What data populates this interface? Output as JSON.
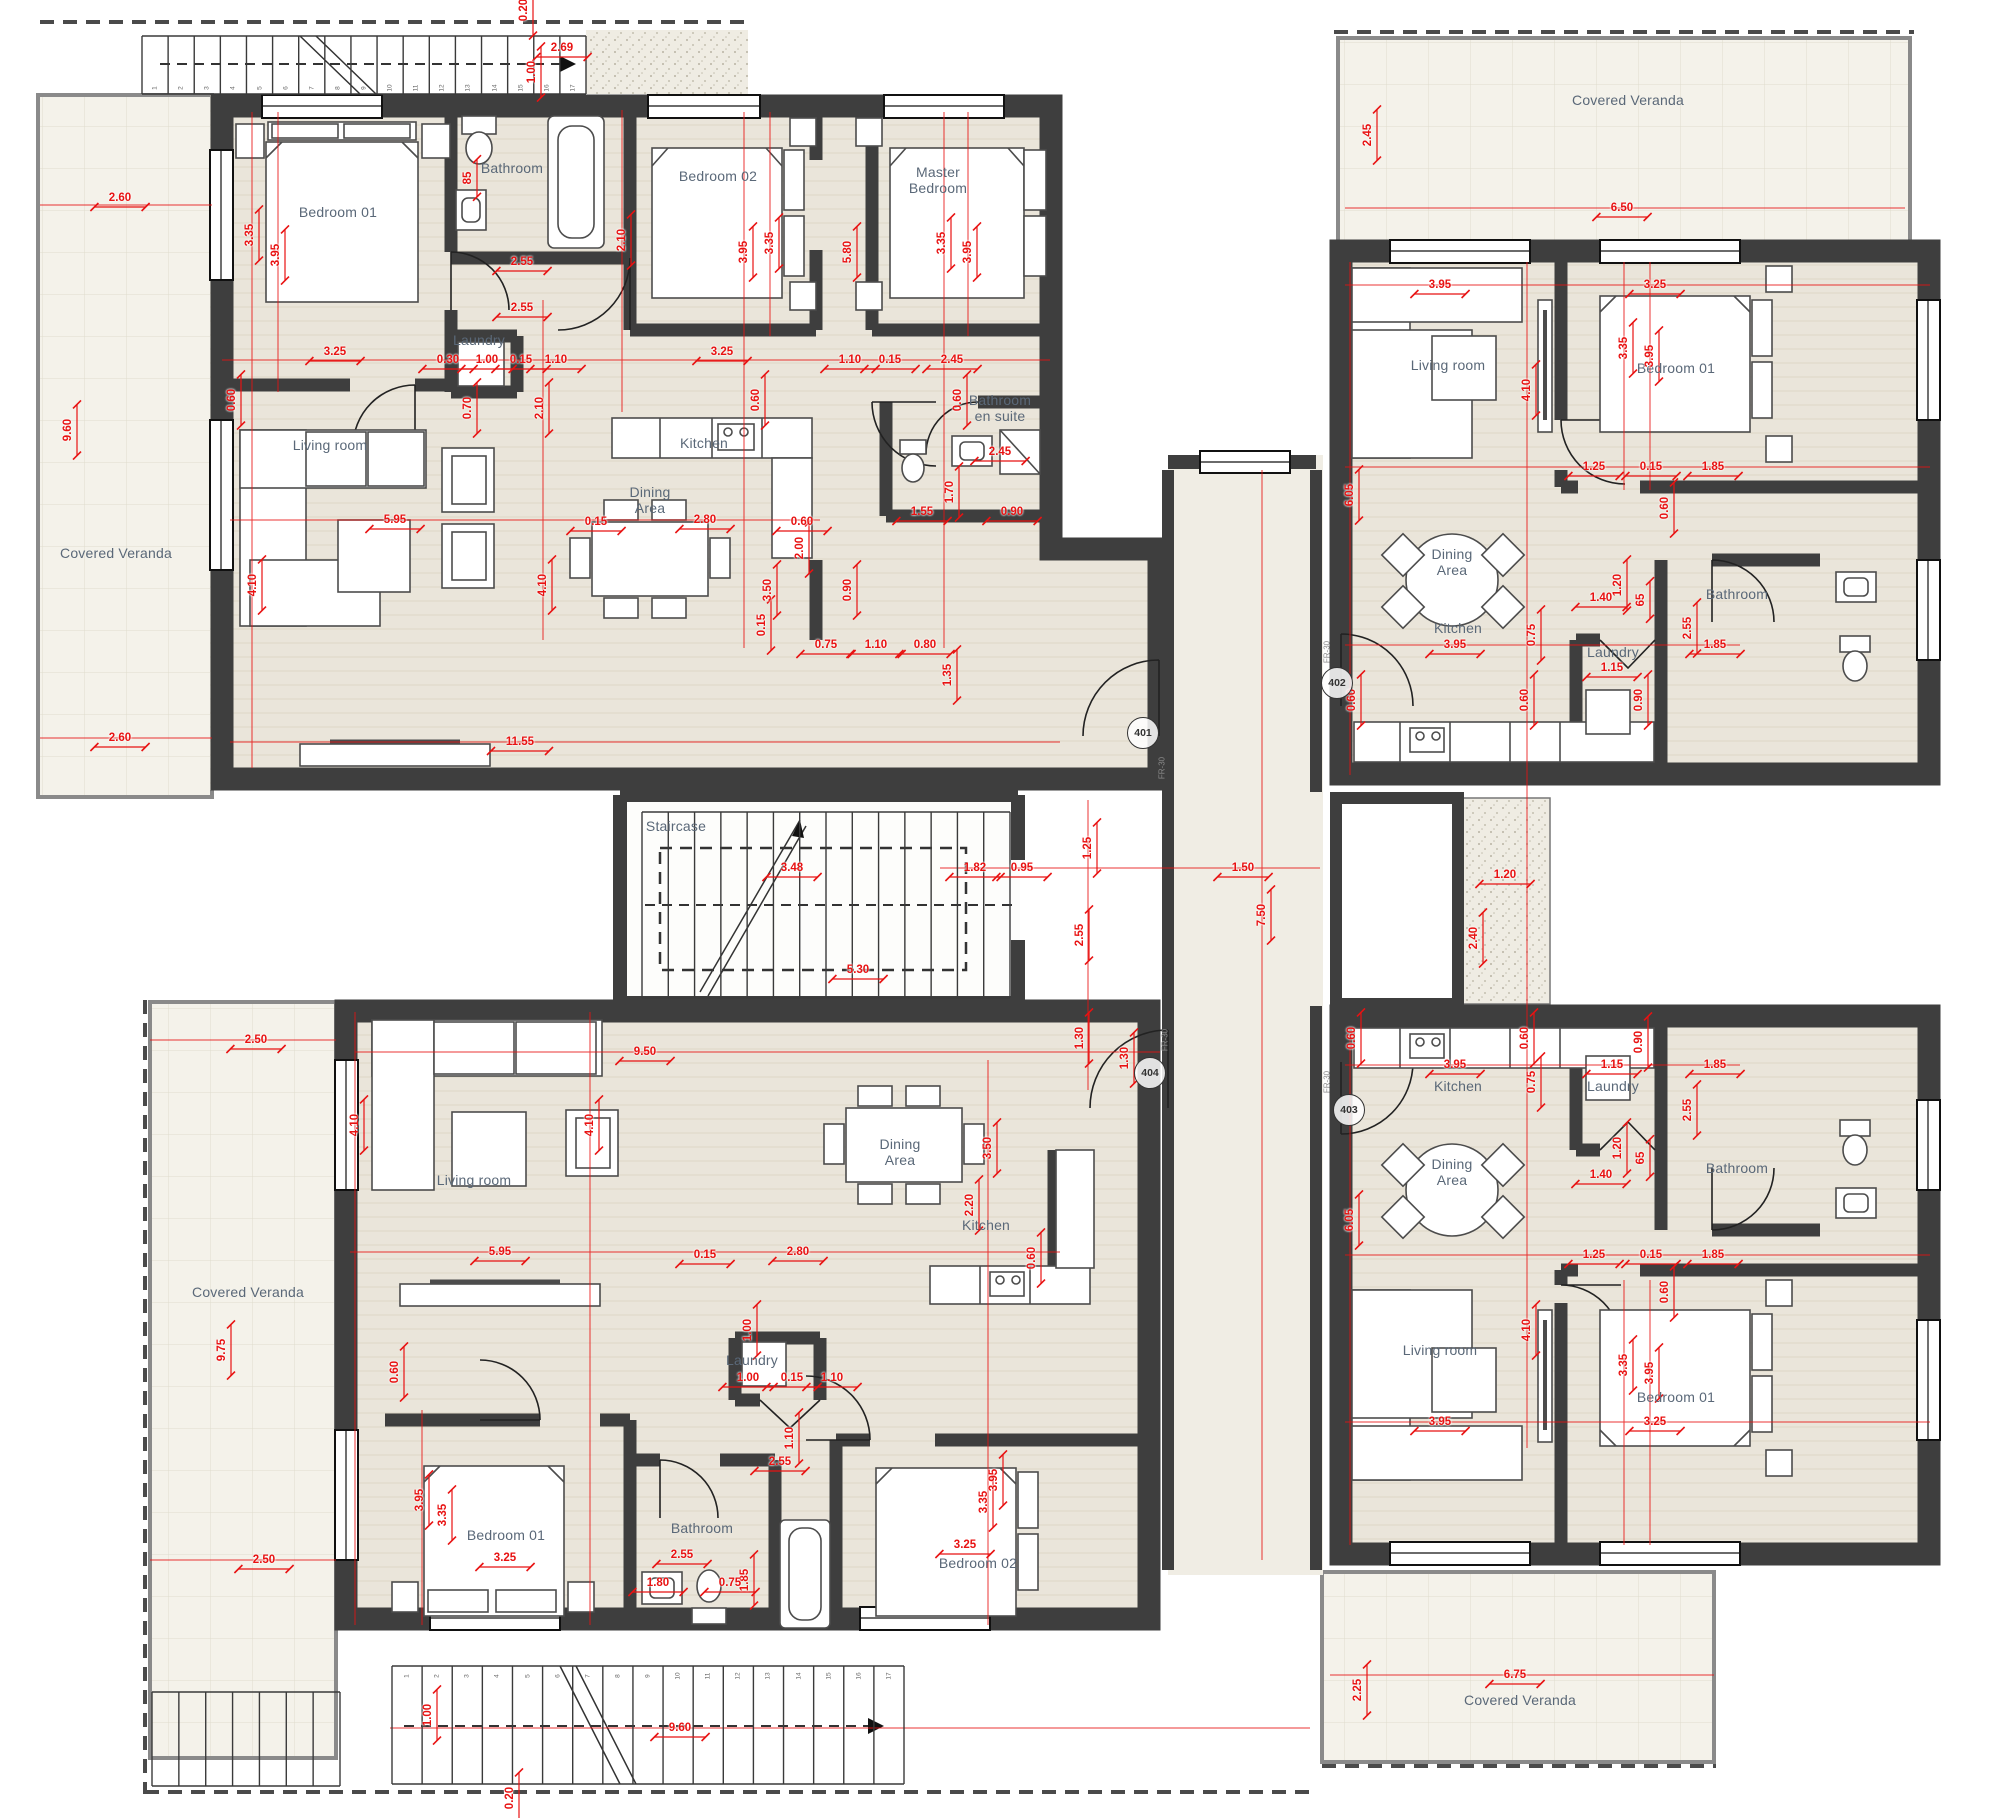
{
  "plan_title": "Typical floor plan – four apartments",
  "colors": {
    "wall": "#3e3e3e",
    "floor": "#eae5da",
    "veranda": "#f4f2ea",
    "corridor": "#f0ede4",
    "dim_red": "#e81212",
    "label_gray": "#5a6878"
  },
  "room_labels": [
    {
      "t": "Covered Veranda",
      "x": 116,
      "y": 553
    },
    {
      "t": "Bedroom 01",
      "x": 338,
      "y": 212
    },
    {
      "t": "Bathroom",
      "x": 512,
      "y": 168
    },
    {
      "t": "Laundry",
      "x": 479,
      "y": 340
    },
    {
      "t": "Bedroom 02",
      "x": 718,
      "y": 176
    },
    {
      "t": "Master\nBedroom",
      "x": 938,
      "y": 180
    },
    {
      "t": "Bathroom\nen suite",
      "x": 1000,
      "y": 408
    },
    {
      "t": "Living room",
      "x": 330,
      "y": 445
    },
    {
      "t": "Dining\nArea",
      "x": 650,
      "y": 500
    },
    {
      "t": "Kitchen",
      "x": 704,
      "y": 443
    },
    {
      "t": "Staircase",
      "x": 676,
      "y": 826
    },
    {
      "t": "Covered Veranda",
      "x": 1628,
      "y": 100
    },
    {
      "t": "Living room",
      "x": 1448,
      "y": 365
    },
    {
      "t": "Bedroom 01",
      "x": 1676,
      "y": 368
    },
    {
      "t": "Dining\nArea",
      "x": 1452,
      "y": 562
    },
    {
      "t": "Kitchen",
      "x": 1458,
      "y": 628
    },
    {
      "t": "Bathroom",
      "x": 1737,
      "y": 594
    },
    {
      "t": "Laundry",
      "x": 1613,
      "y": 652
    },
    {
      "t": "Kitchen",
      "x": 1458,
      "y": 1086
    },
    {
      "t": "Laundry",
      "x": 1613,
      "y": 1086
    },
    {
      "t": "Bathroom",
      "x": 1737,
      "y": 1168
    },
    {
      "t": "Dining\nArea",
      "x": 1452,
      "y": 1172
    },
    {
      "t": "Living room",
      "x": 1440,
      "y": 1350
    },
    {
      "t": "Bedroom 01",
      "x": 1676,
      "y": 1397
    },
    {
      "t": "Covered Veranda",
      "x": 1520,
      "y": 1700
    },
    {
      "t": "Covered Veranda",
      "x": 248,
      "y": 1292
    },
    {
      "t": "Living room",
      "x": 474,
      "y": 1180
    },
    {
      "t": "Dining\nArea",
      "x": 900,
      "y": 1152
    },
    {
      "t": "Kitchen",
      "x": 986,
      "y": 1225
    },
    {
      "t": "Laundry",
      "x": 752,
      "y": 1360
    },
    {
      "t": "Bedroom 01",
      "x": 506,
      "y": 1535
    },
    {
      "t": "Bathroom",
      "x": 702,
      "y": 1528
    },
    {
      "t": "Bedroom 02",
      "x": 978,
      "y": 1563
    }
  ],
  "badges": [
    {
      "t": "401",
      "x": 1143,
      "y": 733
    },
    {
      "t": "402",
      "x": 1337,
      "y": 683
    },
    {
      "t": "403",
      "x": 1349,
      "y": 1110
    },
    {
      "t": "404",
      "x": 1150,
      "y": 1073
    }
  ],
  "door_tags": [
    {
      "t": "FR-30",
      "x": 1162,
      "y": 768
    },
    {
      "t": "FR-30",
      "x": 1327,
      "y": 652
    },
    {
      "t": "FR-30",
      "x": 1327,
      "y": 1082
    },
    {
      "t": "FR-30",
      "x": 1165,
      "y": 1040
    }
  ],
  "dims": [
    [
      "2.60",
      120,
      198,
      0
    ],
    [
      "9.60",
      68,
      430,
      1
    ],
    [
      "2.60",
      120,
      738,
      0
    ],
    [
      "0.20",
      524,
      10,
      1
    ],
    [
      "2.69",
      562,
      48,
      0
    ],
    [
      "1.00",
      532,
      72,
      1
    ],
    [
      "3.35",
      250,
      235,
      1
    ],
    [
      "3.95",
      276,
      255,
      1
    ],
    [
      "0.60",
      232,
      400,
      1
    ],
    [
      "3.25",
      335,
      352,
      0
    ],
    [
      "2.55",
      522,
      262,
      0
    ],
    [
      "2.55",
      522,
      308,
      0
    ],
    [
      "85",
      468,
      178,
      1
    ],
    [
      "0.30",
      448,
      360,
      0
    ],
    [
      "1.00",
      487,
      360,
      0
    ],
    [
      "0.15",
      521,
      360,
      0
    ],
    [
      "1.10",
      556,
      360,
      0
    ],
    [
      "0.70",
      468,
      408,
      1
    ],
    [
      "2.10",
      540,
      408,
      1
    ],
    [
      "2.10",
      622,
      240,
      1
    ],
    [
      "3.95",
      744,
      252,
      1
    ],
    [
      "3.35",
      770,
      243,
      1
    ],
    [
      "3.25",
      722,
      352,
      0
    ],
    [
      "1.10",
      850,
      360,
      0
    ],
    [
      "0.15",
      890,
      360,
      0
    ],
    [
      "2.45",
      952,
      360,
      0
    ],
    [
      "5.80",
      848,
      252,
      1
    ],
    [
      "3.35",
      942,
      243,
      1
    ],
    [
      "3.95",
      968,
      252,
      1
    ],
    [
      "0.60",
      756,
      400,
      1
    ],
    [
      "0.60",
      958,
      400,
      1
    ],
    [
      "2.45",
      1000,
      452,
      0
    ],
    [
      "1.70",
      950,
      492,
      1
    ],
    [
      "1.55",
      922,
      512,
      0
    ],
    [
      "0.90",
      1012,
      512,
      0
    ],
    [
      "5.95",
      395,
      520,
      0
    ],
    [
      "0.15",
      596,
      522,
      0
    ],
    [
      "2.80",
      705,
      520,
      0
    ],
    [
      "0.60",
      802,
      522,
      0
    ],
    [
      "4.10",
      253,
      585,
      1
    ],
    [
      "4.10",
      543,
      585,
      1
    ],
    [
      "3.50",
      768,
      590,
      1
    ],
    [
      "2.00",
      800,
      548,
      1
    ],
    [
      "0.90",
      848,
      590,
      1
    ],
    [
      "0.15",
      762,
      625,
      1
    ],
    [
      "0.75",
      826,
      645,
      0
    ],
    [
      "1.10",
      876,
      645,
      0
    ],
    [
      "0.80",
      925,
      645,
      0
    ],
    [
      "1.35",
      948,
      675,
      1
    ],
    [
      "11.55",
      520,
      742,
      0
    ],
    [
      "1.25",
      1088,
      848,
      1
    ],
    [
      "1.82",
      975,
      868,
      0
    ],
    [
      "0.95",
      1022,
      868,
      0
    ],
    [
      "1.50",
      1243,
      868,
      0
    ],
    [
      "7.50",
      1262,
      915,
      1
    ],
    [
      "2.55",
      1080,
      935,
      1
    ],
    [
      "1.30",
      1080,
      1038,
      1
    ],
    [
      "3.48",
      792,
      868,
      0
    ],
    [
      "5.30",
      858,
      970,
      0
    ],
    [
      "2.45",
      1368,
      135,
      1
    ],
    [
      "6.50",
      1622,
      208,
      0
    ],
    [
      "3.95",
      1440,
      285,
      0
    ],
    [
      "3.25",
      1655,
      285,
      0
    ],
    [
      "4.10",
      1527,
      390,
      1
    ],
    [
      "6.05",
      1350,
      495,
      1
    ],
    [
      "3.35",
      1624,
      348,
      1
    ],
    [
      "3.95",
      1650,
      356,
      1
    ],
    [
      "1.25",
      1594,
      467,
      0
    ],
    [
      "0.15",
      1651,
      467,
      0
    ],
    [
      "1.85",
      1713,
      467,
      0
    ],
    [
      "0.60",
      1665,
      508,
      1
    ],
    [
      "1.20",
      1618,
      585,
      1
    ],
    [
      "1.40",
      1601,
      598,
      0
    ],
    [
      "65",
      1641,
      600,
      1
    ],
    [
      "2.55",
      1688,
      628,
      1
    ],
    [
      "1.15",
      1612,
      668,
      0
    ],
    [
      "0.75",
      1532,
      635,
      1
    ],
    [
      "3.95",
      1455,
      645,
      0
    ],
    [
      "0.60",
      1352,
      700,
      1
    ],
    [
      "0.60",
      1525,
      700,
      1
    ],
    [
      "0.90",
      1639,
      700,
      1
    ],
    [
      "1.85",
      1715,
      645,
      0
    ],
    [
      "1.20",
      1505,
      875,
      0
    ],
    [
      "2.40",
      1474,
      938,
      1
    ],
    [
      "0.60",
      1352,
      1038,
      1
    ],
    [
      "0.60",
      1525,
      1038,
      1
    ],
    [
      "3.95",
      1455,
      1065,
      0
    ],
    [
      "1.15",
      1612,
      1065,
      0
    ],
    [
      "0.90",
      1639,
      1042,
      1
    ],
    [
      "1.85",
      1715,
      1065,
      0
    ],
    [
      "0.75",
      1532,
      1082,
      1
    ],
    [
      "2.55",
      1688,
      1110,
      1
    ],
    [
      "1.40",
      1601,
      1175,
      0
    ],
    [
      "65",
      1641,
      1158,
      1
    ],
    [
      "1.20",
      1618,
      1148,
      1
    ],
    [
      "6.05",
      1350,
      1220,
      1
    ],
    [
      "1.25",
      1594,
      1255,
      0
    ],
    [
      "0.15",
      1651,
      1255,
      0
    ],
    [
      "1.85",
      1713,
      1255,
      0
    ],
    [
      "0.60",
      1665,
      1292,
      1
    ],
    [
      "4.10",
      1527,
      1330,
      1
    ],
    [
      "3.35",
      1624,
      1365,
      1
    ],
    [
      "3.95",
      1650,
      1373,
      1
    ],
    [
      "3.95",
      1440,
      1422,
      0
    ],
    [
      "3.25",
      1655,
      1422,
      0
    ],
    [
      "6.75",
      1515,
      1675,
      0
    ],
    [
      "2.25",
      1358,
      1690,
      1
    ],
    [
      "2.50",
      256,
      1040,
      0
    ],
    [
      "9.50",
      645,
      1052,
      0
    ],
    [
      "1.30",
      1125,
      1058,
      1
    ],
    [
      "4.10",
      355,
      1125,
      1
    ],
    [
      "4.10",
      590,
      1125,
      1
    ],
    [
      "3.50",
      988,
      1148,
      1
    ],
    [
      "2.20",
      970,
      1205,
      1
    ],
    [
      "9.75",
      222,
      1350,
      1
    ],
    [
      "5.95",
      500,
      1252,
      0
    ],
    [
      "0.15",
      705,
      1255,
      0
    ],
    [
      "2.80",
      798,
      1252,
      0
    ],
    [
      "0.60",
      1032,
      1258,
      1
    ],
    [
      "1.00",
      748,
      1330,
      1
    ],
    [
      "0.60",
      395,
      1372,
      1
    ],
    [
      "1.00",
      748,
      1378,
      0
    ],
    [
      "0.15",
      792,
      1378,
      0
    ],
    [
      "1.10",
      832,
      1378,
      0
    ],
    [
      "1.10",
      790,
      1438,
      1
    ],
    [
      "2.55",
      780,
      1462,
      0
    ],
    [
      "3.95",
      420,
      1500,
      1
    ],
    [
      "3.35",
      443,
      1515,
      1
    ],
    [
      "3.25",
      505,
      1558,
      0
    ],
    [
      "2.55",
      682,
      1555,
      0
    ],
    [
      "1.80",
      658,
      1583,
      0
    ],
    [
      "1.85",
      745,
      1580,
      1
    ],
    [
      "0.75",
      730,
      1583,
      0
    ],
    [
      "3.95",
      994,
      1480,
      1
    ],
    [
      "3.35",
      984,
      1502,
      1
    ],
    [
      "3.25",
      965,
      1545,
      0
    ],
    [
      "2.50",
      264,
      1560,
      0
    ],
    [
      "9.60",
      680,
      1728,
      0
    ],
    [
      "1.00",
      428,
      1715,
      1
    ],
    [
      "0.20",
      510,
      1798,
      1
    ]
  ],
  "stairs": [
    {
      "x": 142,
      "y": 36,
      "w": 444,
      "h": 58,
      "n": 17,
      "numY": 88,
      "numStart": 1
    },
    {
      "x": 586,
      "y": 36,
      "w": 0,
      "h": 0,
      "n": 0
    },
    {
      "x": 642,
      "y": 812,
      "w": 368,
      "h": 186,
      "n": 14
    },
    {
      "x": 392,
      "y": 1666,
      "w": 512,
      "h": 118,
      "n": 17,
      "numY": 1676,
      "numStart": 1
    },
    {
      "x": 152,
      "y": 1692,
      "w": 188,
      "h": 94,
      "n": 7
    }
  ]
}
